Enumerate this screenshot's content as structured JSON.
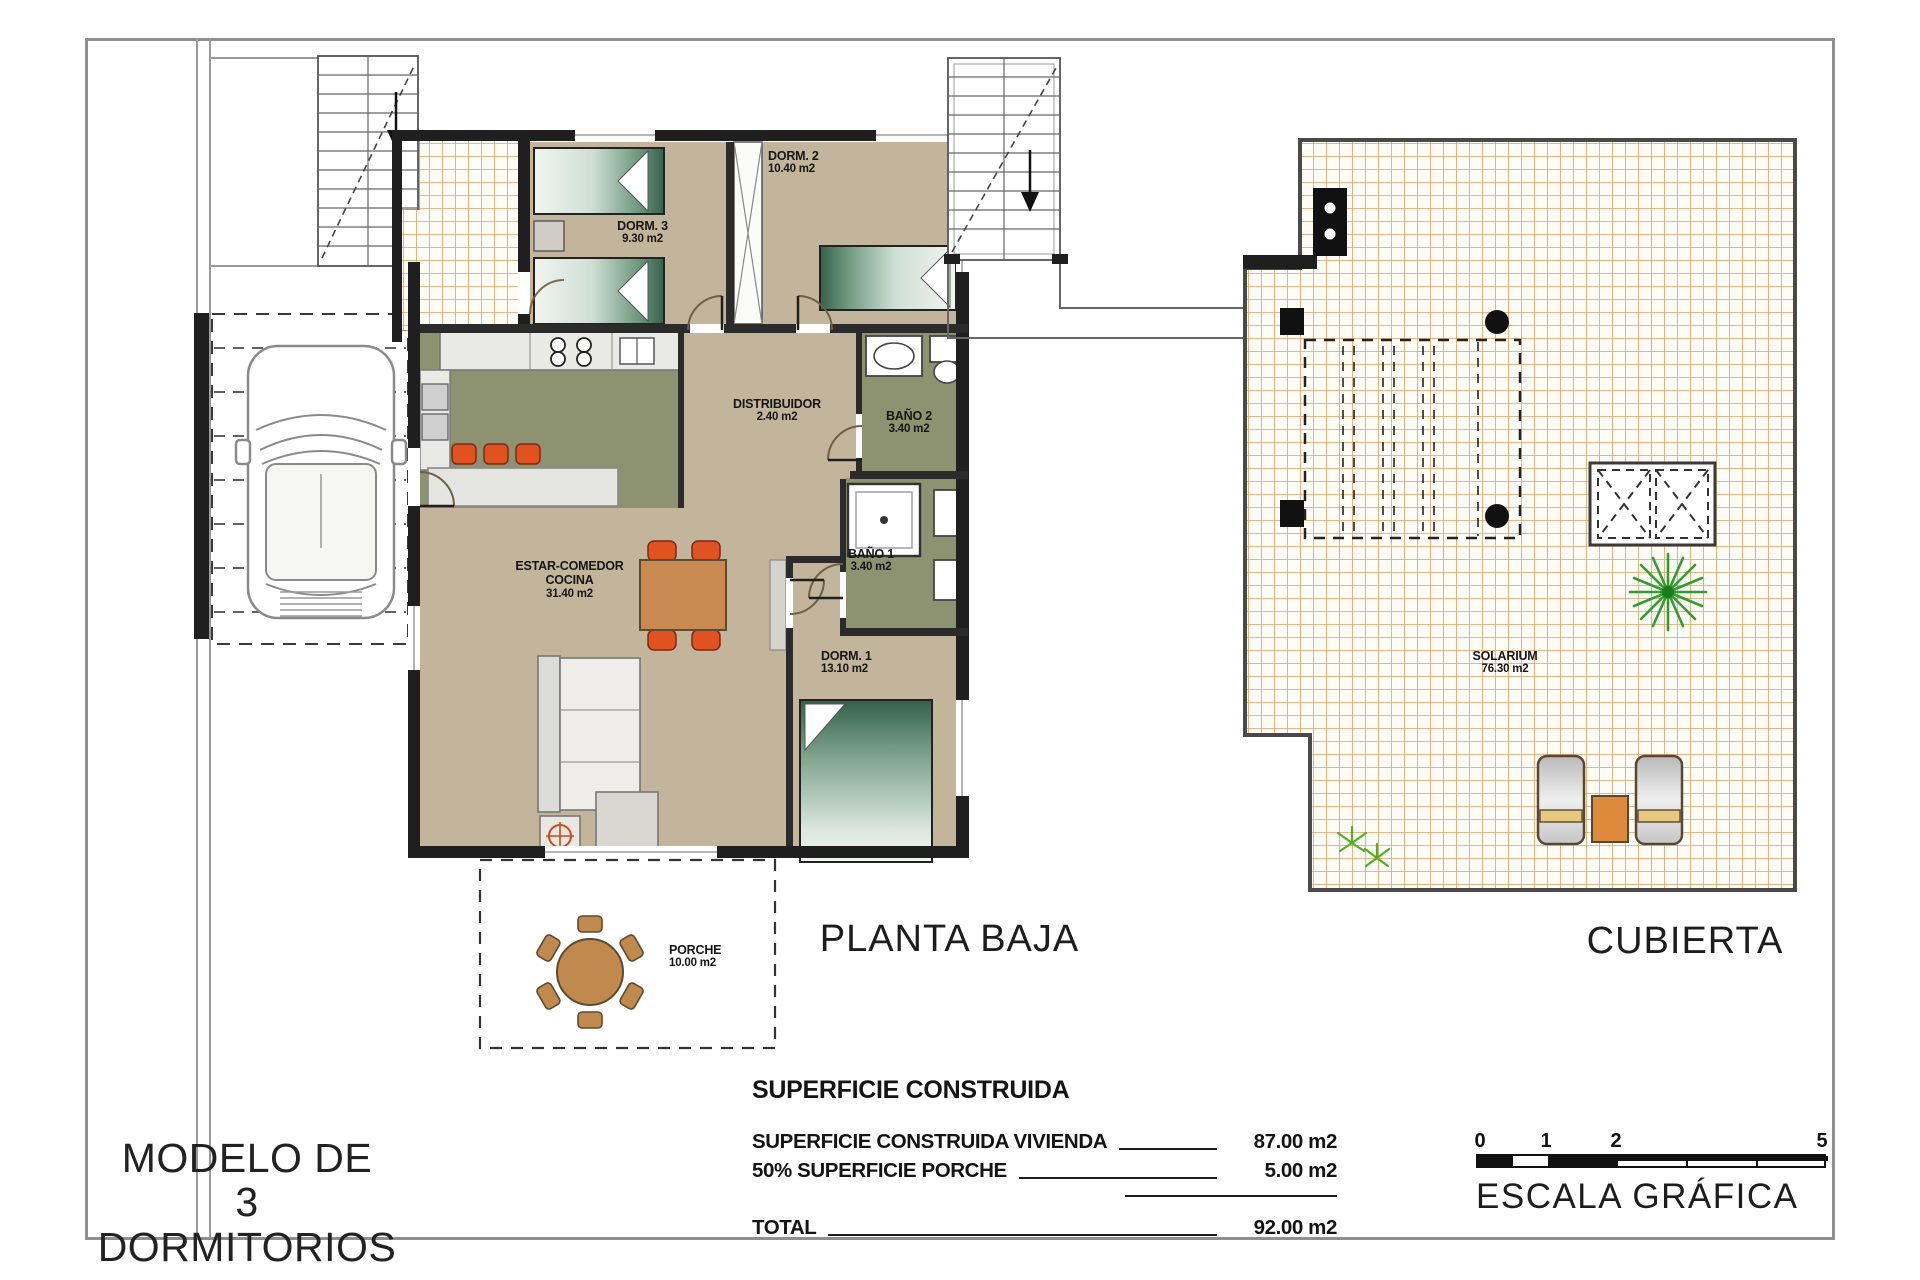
{
  "page": {
    "model_title_line1": "MODELO DE",
    "model_title_line2": "3 DORMITORIOS"
  },
  "plans": {
    "planta_baja": {
      "title": "PLANTA BAJA"
    },
    "cubierta": {
      "title": "CUBIERTA"
    }
  },
  "rooms": {
    "dorm3": {
      "name": "DORM. 3",
      "area": "9.30 m2"
    },
    "dorm2": {
      "name": "DORM. 2",
      "area": "10.40 m2"
    },
    "distribuidor": {
      "name": "DISTRIBUIDOR",
      "area": "2.40 m2"
    },
    "bano2": {
      "name": "BAÑO 2",
      "area": "3.40 m2"
    },
    "bano1": {
      "name": "BAÑO 1",
      "area": "3.40 m2"
    },
    "dorm1": {
      "name": "DORM. 1",
      "area": "13.10 m2"
    },
    "estar_comedor": {
      "name": "ESTAR-COMEDOR",
      "name2": "COCINA",
      "area": "31.40 m2"
    },
    "porche": {
      "name": "PORCHE",
      "area": "10.00 m2"
    },
    "solarium": {
      "name": "SOLARIUM",
      "area": "76.30 m2"
    }
  },
  "summary": {
    "header": "SUPERFICIE CONSTRUIDA",
    "rows": [
      {
        "label": "SUPERFICIE CONSTRUIDA VIVIENDA",
        "value": "87.00 m2"
      },
      {
        "label": "50% SUPERFICIE PORCHE",
        "value": "5.00 m2"
      }
    ],
    "total_label": "TOTAL",
    "total_value": "92.00 m2"
  },
  "scale_bar": {
    "label": "ESCALA GRÁFICA",
    "ticks": [
      "0",
      "1",
      "2",
      "5"
    ]
  },
  "colors": {
    "floor_tan": "#c2b59c",
    "floor_green": "#8d9271",
    "tile_line": "#dfa06a",
    "accent_orange": "#e05320",
    "wood": "#c98a52",
    "wall": "#1f1f1f",
    "plant_green": "#2f9e2f"
  }
}
